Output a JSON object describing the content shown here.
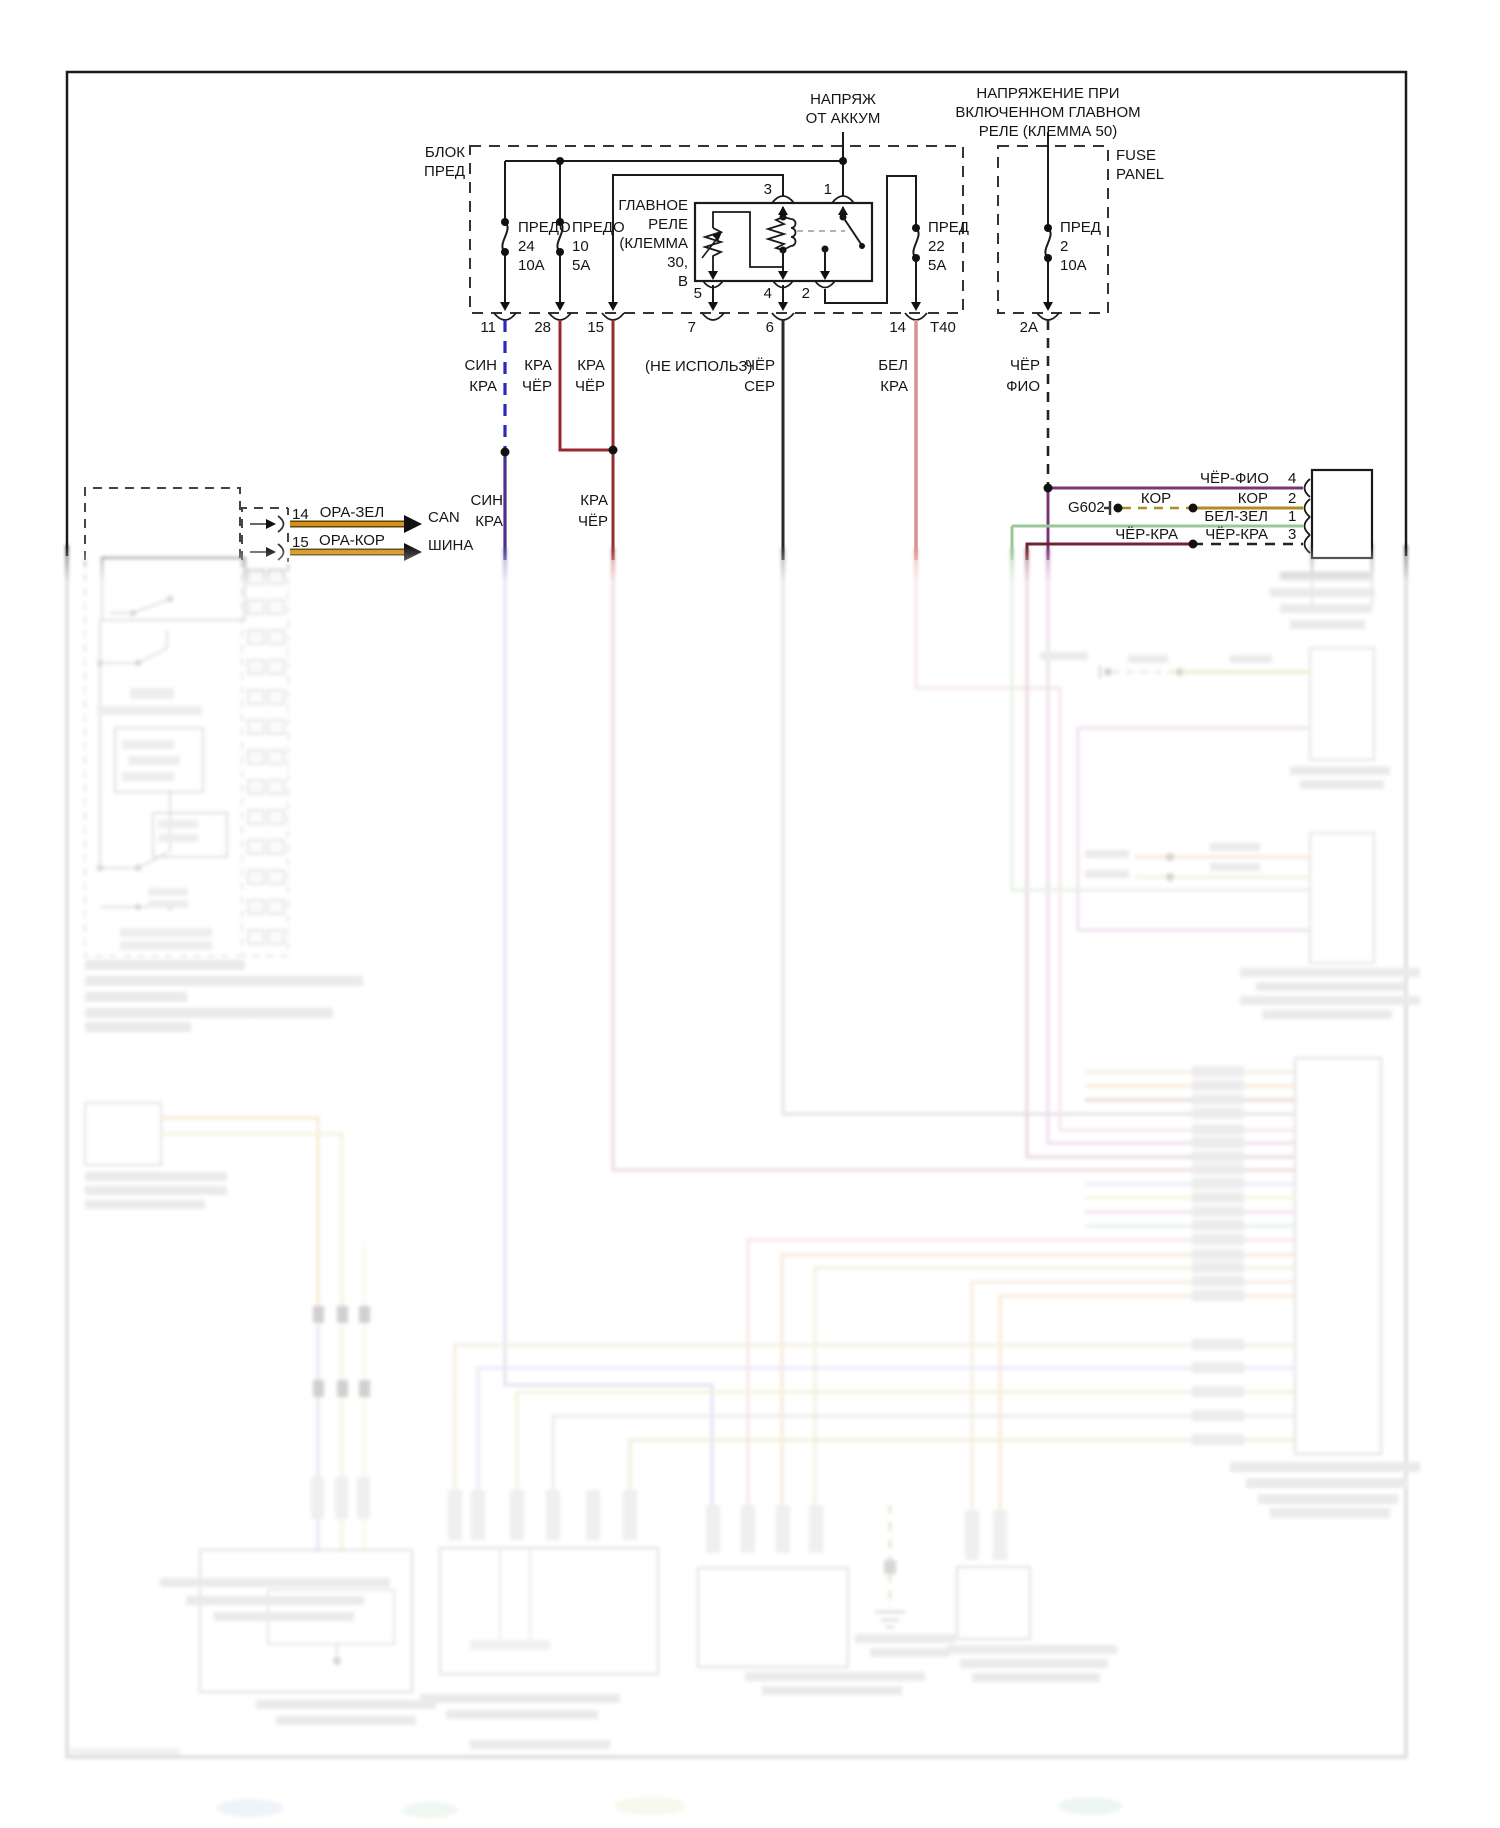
{
  "fuse_block": {
    "title1": "БЛОК",
    "title2": "ПРЕД"
  },
  "fuses": {
    "f24": {
      "name": "ПРЕДО",
      "num": "24",
      "amp": "10А"
    },
    "f10": {
      "name": "ПРЕДО",
      "num": "10",
      "amp": "5А"
    },
    "f22": {
      "name": "ПРЕД",
      "num": "22",
      "amp": "5А"
    },
    "f2": {
      "name": "ПРЕД",
      "num": "2",
      "amp": "10А"
    }
  },
  "relay": {
    "l1": "ГЛАВНОЕ",
    "l2": "РЕЛЕ",
    "l3": "(КЛЕММА",
    "l4": "30,",
    "l5": "В",
    "p3": "3",
    "p1": "1",
    "p5": "5",
    "p4": "4",
    "p2": "2"
  },
  "battery": {
    "l1": "НАПРЯЖ",
    "l2": "ОТ АККУМ"
  },
  "relay50": {
    "l1": "НАПРЯЖЕНИЕ ПРИ",
    "l2": "ВКЛЮЧЕННОМ ГЛАВНОМ",
    "l3": "РЕЛЕ (КЛЕММА 50)"
  },
  "fuse_panel": {
    "l1": "FUSE",
    "l2": "PANEL"
  },
  "conn": {
    "p11": "11",
    "p28": "28",
    "p15": "15",
    "p7": "7",
    "p6": "6",
    "p14": "14",
    "t40": "Т40",
    "p2a": "2А"
  },
  "wires": {
    "w11a": "СИН",
    "w11b": "КРА",
    "w28a": "КРА",
    "w28b": "ЧЁР",
    "w15a": "КРА",
    "w15b": "ЧЁР",
    "w7": "(НЕ ИСПОЛЬЗ)",
    "w6a": "ЧЁР",
    "w6b": "СЕР",
    "w14a": "БЕЛ",
    "w14b": "КРА",
    "w2aa": "ЧЁР",
    "w2ab": "ФИО"
  },
  "wires2": {
    "w11a": "СИН",
    "w11b": "КРА",
    "w15a": "КРА",
    "w15b": "ЧЁР"
  },
  "can": {
    "p14": "14",
    "p15": "15",
    "w14": "ОРА-ЗЕЛ",
    "w15": "ОРА-КОР",
    "bus1": "CAN",
    "bus2": "ШИНА"
  },
  "ecu": {
    "g602": "G602",
    "r4l": "ЧЁР-ФИО",
    "r4p": "4",
    "r2l": "КОР",
    "r2r": "КОР",
    "r2p": "2",
    "r1l": "БЕЛ-ЗЕЛ",
    "r1p": "1",
    "r3l": "ЧЁР-КРА",
    "r3r": "ЧЁР-КРА",
    "r3p": "3"
  },
  "colors": {
    "blue_dashed": "#2a2ab8",
    "violet": "#4a3090",
    "dark_red": "#962a30",
    "black_wire": "#2a2a2a",
    "pink": "#d99090",
    "purple": "#7a3578",
    "olive": "#b08c20",
    "green": "#98c898",
    "maroon": "#6f2430",
    "orange_can": "#d89018"
  }
}
